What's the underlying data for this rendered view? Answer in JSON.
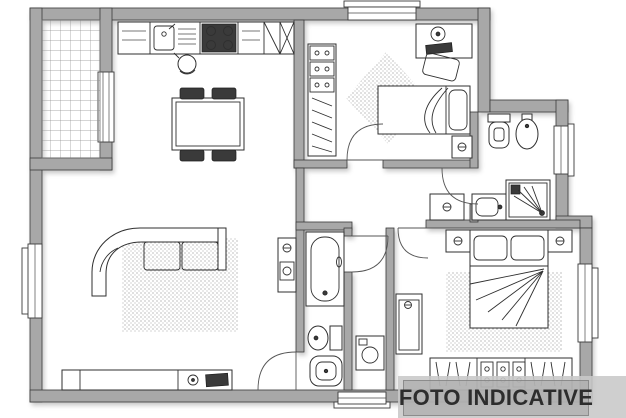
{
  "canvas": {
    "width": 626,
    "height": 418
  },
  "watermark": {
    "label": "FOTO INDICATIVE"
  },
  "palette": {
    "background": "#ffffff",
    "wall-fill": "#a8a8a8",
    "wall-stroke": "#3a3a3a",
    "dark-fill": "#3a3a3a",
    "line": "#2f2f2f",
    "rug-dot": "#9d9d9d",
    "tile-line": "#8f8f8f",
    "band": "#c8c8c8",
    "panel": "#a2a2a2",
    "text-color": "#2d2d2d"
  },
  "drawing": {
    "type": "apartment-floor-plan",
    "rooms": [
      "balcony",
      "kitchen-dining-room",
      "living-room",
      "bedroom",
      "bathroom",
      "hallway",
      "second-bathroom",
      "master-bedroom"
    ],
    "fixtures": [
      "tiled-floor",
      "kitchen-counter",
      "kitchen-sink",
      "gas-stove",
      "wall-cabinets",
      "kettle",
      "dining-table",
      "dining-chairs",
      "corner-sofa",
      "area-rugs",
      "tv-sideboard",
      "television",
      "storage-cabinets",
      "washing-machines",
      "desk",
      "desk-chair",
      "desk-lamp",
      "single-bed",
      "wardrobes",
      "toilets",
      "bidets",
      "shower",
      "washbasin",
      "bathtub",
      "double-bed",
      "nightstands",
      "windows",
      "interior-doors"
    ]
  }
}
